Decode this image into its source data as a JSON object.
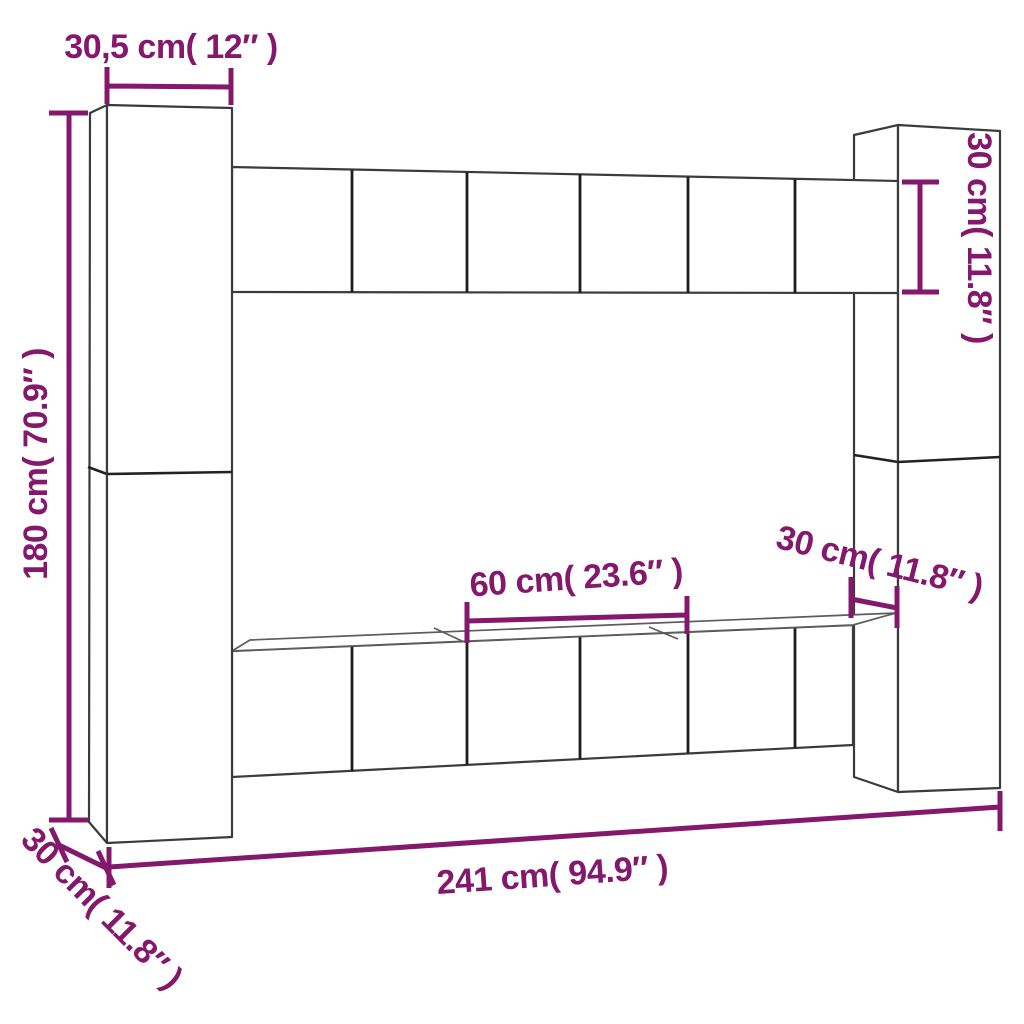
{
  "figure": {
    "type": "furniture-dimension-diagram",
    "subject": "TV wall unit cabinet set line drawing"
  },
  "colors": {
    "dimension": "#83186D",
    "outline": "#3B3B3B",
    "background": "#FFFFFF"
  },
  "dimensions": {
    "top_width": {
      "label": "30,5 cm( 12″ )",
      "cm": 30.5,
      "inches": 12,
      "measures": "width of left tall cabinet",
      "orientation": "horizontal"
    },
    "left_height": {
      "label": "180 cm( 70.9″ )",
      "cm": 180,
      "inches": 70.9,
      "measures": "total height of left tall cabinets",
      "orientation": "vertical"
    },
    "right_unit_height": {
      "label": "30 cm( 11.8″ )",
      "cm": 30,
      "inches": 11.8,
      "measures": "height of hanging cabinet row",
      "orientation": "vertical"
    },
    "shelf_width": {
      "label": "60 cm( 23.6″ )",
      "cm": 60,
      "inches": 23.6,
      "measures": "width of one lower cabinet",
      "orientation": "horizontal"
    },
    "shelf_depth": {
      "label": "30 cm( 11.8″ )",
      "cm": 30,
      "inches": 11.8,
      "measures": "depth of lower cabinet row",
      "orientation": "diagonal"
    },
    "total_width": {
      "label": "241 cm( 94.9″ )",
      "cm": 241,
      "inches": 94.9,
      "measures": "total width of wall unit",
      "orientation": "horizontal"
    },
    "side_depth": {
      "label": "30 cm( 11.8″ )",
      "cm": 30,
      "inches": 11.8,
      "measures": "depth of left tall cabinet",
      "orientation": "diagonal"
    }
  }
}
